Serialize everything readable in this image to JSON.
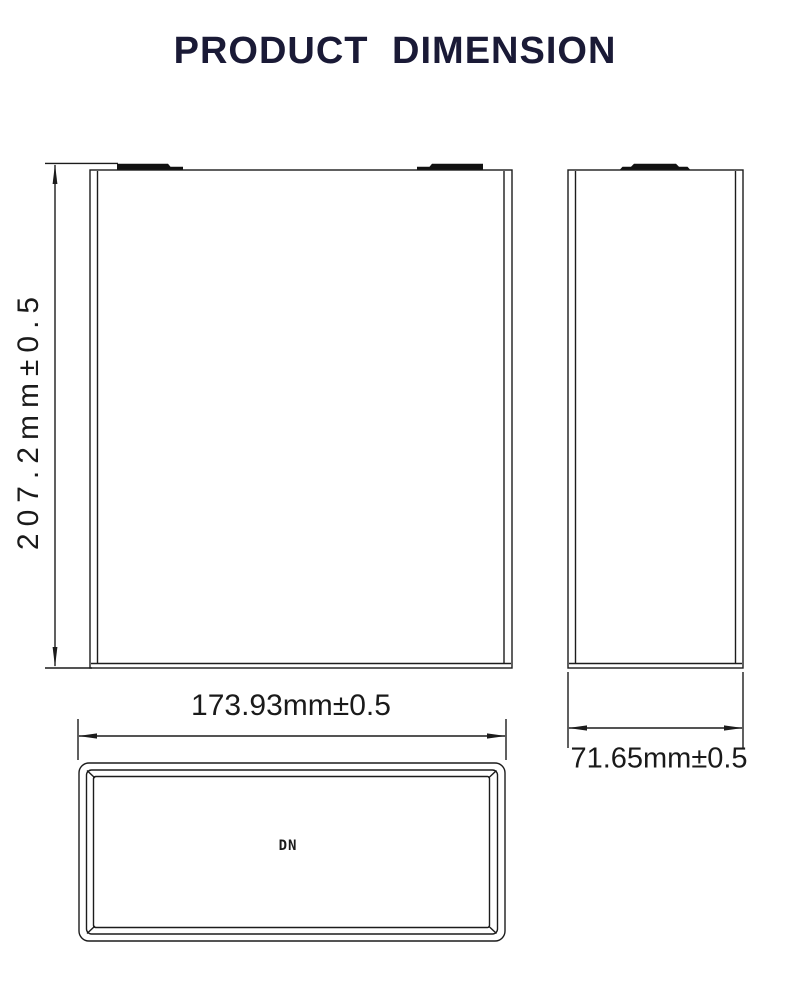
{
  "title": "PRODUCT DIMENSION",
  "views": {
    "front": {
      "height_label": "207.2mm±0.5"
    },
    "side": {
      "width_label": "71.65mm±0.5"
    },
    "top": {
      "width_label": "173.93mm±0.5",
      "marking": "DN"
    }
  },
  "colors": {
    "title": "#1a1a36",
    "line": "#1c1c1c",
    "terminal": "#111111",
    "background": "#ffffff",
    "label": "#1a1a1a"
  }
}
